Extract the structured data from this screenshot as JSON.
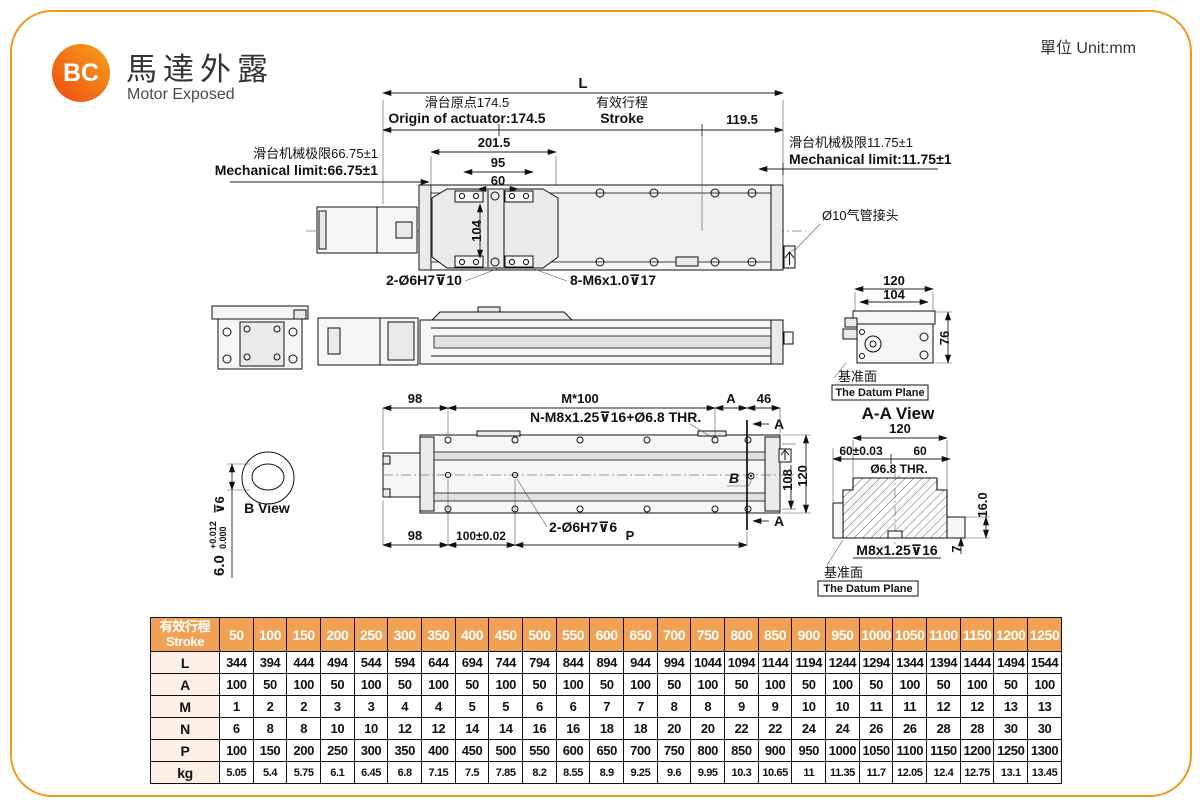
{
  "colors": {
    "frame": "#F0991F",
    "table_header": "#F0A153",
    "table_label_bg": "#FCEFE5"
  },
  "header": {
    "logo": "BC",
    "title_zh": "馬達外露",
    "title_en": "Motor Exposed",
    "unit": "單位 Unit:mm"
  },
  "top_view": {
    "dim_L": "L",
    "origin_zh": "滑台原点174.5",
    "origin_en": "Origin of actuator:174.5",
    "stroke_zh": "有效行程",
    "stroke_en": "Stroke",
    "dim_119_5": "119.5",
    "dim_201_5": "201.5",
    "dim_95": "95",
    "dim_60": "60",
    "dim_104": "104",
    "mech_limit_left_zh": "滑台机械极限66.75±1",
    "mech_limit_left_en": "Mechanical limit:66.75±1",
    "mech_limit_right_zh": "滑台机械极限11.75±1",
    "mech_limit_right_en": "Mechanical limit:11.75±1",
    "air_fitting_label": "Ø10气管接头",
    "hole_label_pin": "2-Ø6H7⊽10",
    "hole_label_thread": "8-M6x1.0⊽17"
  },
  "section_view": {
    "dim_120": "120",
    "dim_104": "104",
    "dim_76": "76",
    "datum_zh": "基准面",
    "datum_en": "The Datum Plane"
  },
  "plan_view": {
    "dim_98_top": "98",
    "dim_m100": "M*100",
    "dim_A": "A",
    "dim_46": "46",
    "thread_label": "N-M8x1.25⊽16+Ø6.8 THR.",
    "pin_label": "2-Ø6H7⊽6",
    "dim_98_bottom": "98",
    "dim_100": "100±0.02",
    "dim_P": "P",
    "dim_108": "108",
    "dim_120": "120",
    "section_marker_top": "A",
    "section_marker_bottom": "A",
    "b_marker": "B"
  },
  "b_view": {
    "label": "B View",
    "dim_main": "6.0",
    "tol_upper": "+0.012",
    "tol_lower": "0.000",
    "depth": "⊽6"
  },
  "aa_view": {
    "title": "A-A View",
    "dim_120": "120",
    "dim_60_tol": "60±0.03",
    "dim_60": "60",
    "thru_label": "Ø6.8 THR.",
    "dim_16": "16.0",
    "dim_7": "7",
    "thread_label": "M8x1.25⊽16",
    "datum_zh": "基准面",
    "datum_en": "The Datum Plane"
  },
  "table": {
    "header_zh": "有效行程",
    "header_en": "Stroke",
    "strokes": [
      "50",
      "100",
      "150",
      "200",
      "250",
      "300",
      "350",
      "400",
      "450",
      "500",
      "550",
      "600",
      "650",
      "700",
      "750",
      "800",
      "850",
      "900",
      "950",
      "1000",
      "1050",
      "1100",
      "1150",
      "1200",
      "1250"
    ],
    "rows": [
      {
        "label": "L",
        "values": [
          "344",
          "394",
          "444",
          "494",
          "544",
          "594",
          "644",
          "694",
          "744",
          "794",
          "844",
          "894",
          "944",
          "994",
          "1044",
          "1094",
          "1144",
          "1194",
          "1244",
          "1294",
          "1344",
          "1394",
          "1444",
          "1494",
          "1544"
        ]
      },
      {
        "label": "A",
        "values": [
          "100",
          "50",
          "100",
          "50",
          "100",
          "50",
          "100",
          "50",
          "100",
          "50",
          "100",
          "50",
          "100",
          "50",
          "100",
          "50",
          "100",
          "50",
          "100",
          "50",
          "100",
          "50",
          "100",
          "50",
          "100"
        ]
      },
      {
        "label": "M",
        "values": [
          "1",
          "2",
          "2",
          "3",
          "3",
          "4",
          "4",
          "5",
          "5",
          "6",
          "6",
          "7",
          "7",
          "8",
          "8",
          "9",
          "9",
          "10",
          "10",
          "11",
          "11",
          "12",
          "12",
          "13",
          "13"
        ]
      },
      {
        "label": "N",
        "values": [
          "6",
          "8",
          "8",
          "10",
          "10",
          "12",
          "12",
          "14",
          "14",
          "16",
          "16",
          "18",
          "18",
          "20",
          "20",
          "22",
          "22",
          "24",
          "24",
          "26",
          "26",
          "28",
          "28",
          "30",
          "30"
        ]
      },
      {
        "label": "P",
        "values": [
          "100",
          "150",
          "200",
          "250",
          "300",
          "350",
          "400",
          "450",
          "500",
          "550",
          "600",
          "650",
          "700",
          "750",
          "800",
          "850",
          "900",
          "950",
          "1000",
          "1050",
          "1100",
          "1150",
          "1200",
          "1250",
          "1300"
        ]
      },
      {
        "label": "kg",
        "values": [
          "5.05",
          "5.4",
          "5.75",
          "6.1",
          "6.45",
          "6.8",
          "7.15",
          "7.5",
          "7.85",
          "8.2",
          "8.55",
          "8.9",
          "9.25",
          "9.6",
          "9.95",
          "10.3",
          "10.65",
          "11",
          "11.35",
          "11.7",
          "12.05",
          "12.4",
          "12.75",
          "13.1",
          "13.45"
        ]
      }
    ]
  }
}
